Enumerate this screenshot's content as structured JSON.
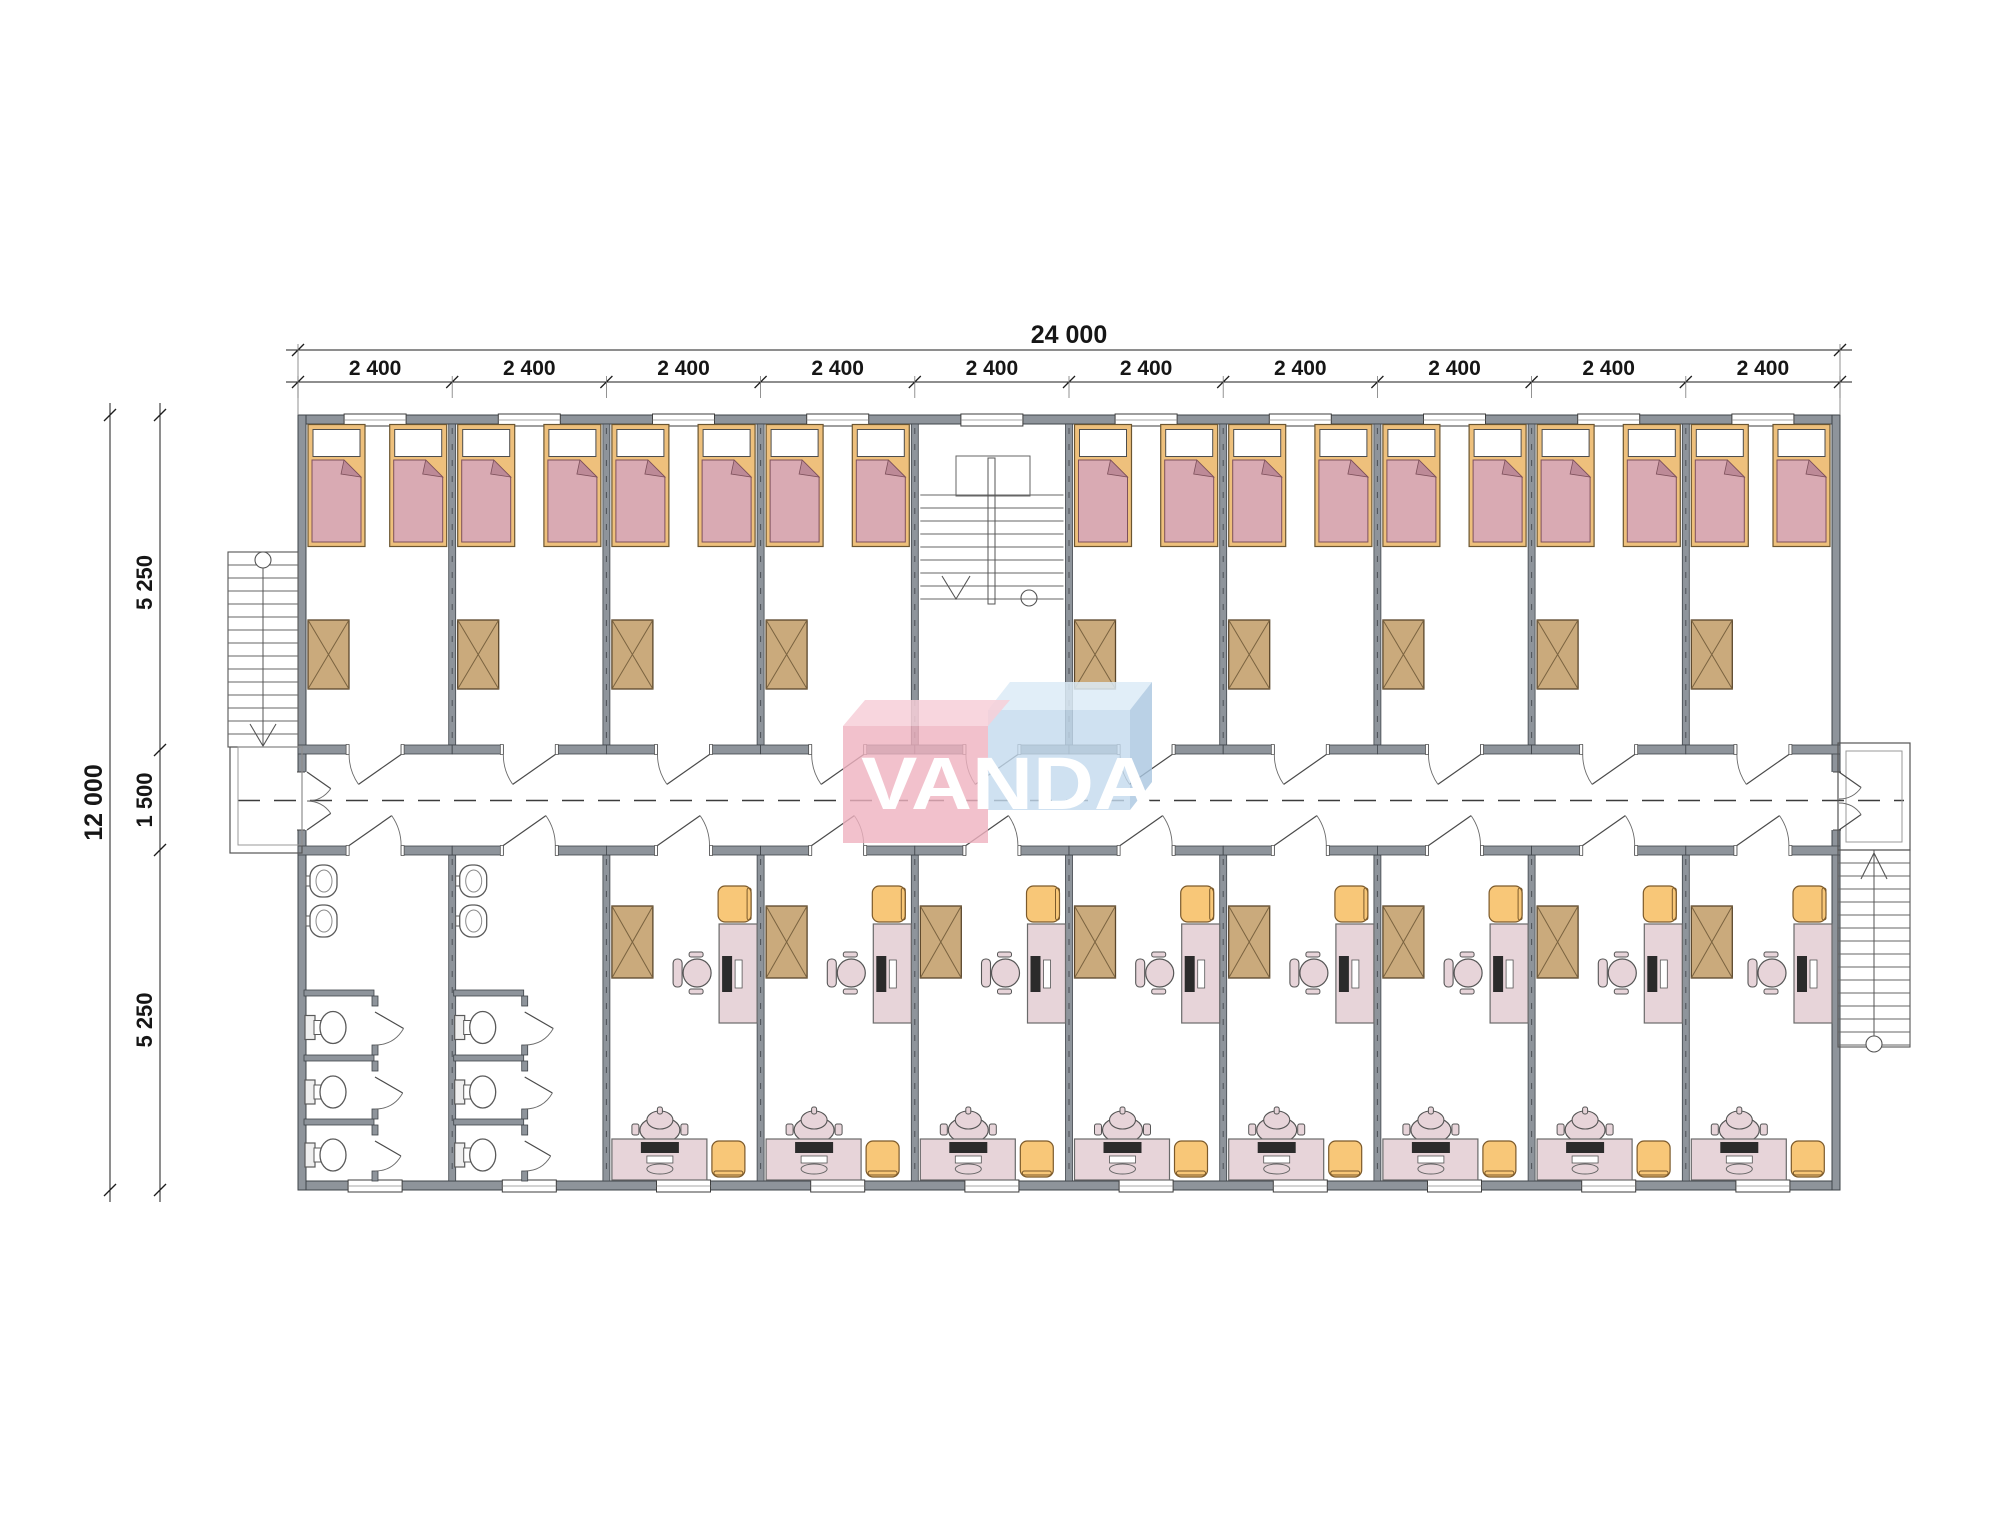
{
  "logo": {
    "text": "VANDA",
    "front_pink": "#efb2bf",
    "top_pink": "#f7cfd8",
    "front_blue": "#c3daee",
    "top_blue": "#dcebf7",
    "side_blue": "#a9c6e0",
    "letter_color": "#ffffff"
  },
  "dimensions": {
    "total_width": "24 000",
    "bays": [
      "2 400",
      "2 400",
      "2 400",
      "2 400",
      "2 400",
      "2 400",
      "2 400",
      "2 400",
      "2 400",
      "2 400"
    ],
    "total_height": "12 000",
    "height_segments": [
      "5 250",
      "1 500",
      "5 250"
    ]
  },
  "plan": {
    "bay_count": 10,
    "stair_bay": 5,
    "bathroom_bays": [
      1,
      2
    ],
    "office_bays": [
      3,
      4,
      5,
      6,
      7,
      8,
      9,
      10
    ],
    "bedroom_bays": [
      1,
      2,
      3,
      4,
      6,
      7,
      8,
      9,
      10
    ],
    "beds_per_bedroom": 2,
    "wardrobes_per_room": 1,
    "sinks_per_bathroom": 2,
    "toilet_stalls_per_bathroom": 3,
    "desks_per_office": 2,
    "external_stairs": 2
  },
  "colors": {
    "wall": "#8e949b",
    "wall_stroke": "#3f444a",
    "line": "#222222",
    "thin": "#555555",
    "bed_frame": "#eec07c",
    "bed_frame_stroke": "#6b5530",
    "pillow": "#ffffff",
    "mattress": "#d9aab3",
    "mattress_stroke": "#7d505b",
    "mattress_fold": "#bd8a97",
    "wardrobe": "#caaa7c",
    "wardrobe_stroke": "#5a462b",
    "desk": "#e7d4d9",
    "desk_stroke": "#6a6a6a",
    "chair": "#e7d4d9",
    "monitor": "#2b2b2b",
    "keyboard": "#ffffff",
    "stool": "#f8c778",
    "stool_stroke": "#7c5a2b",
    "fixture": "#ffffff",
    "fixture_stroke": "#5a5a5a",
    "tank": "#efefef"
  }
}
